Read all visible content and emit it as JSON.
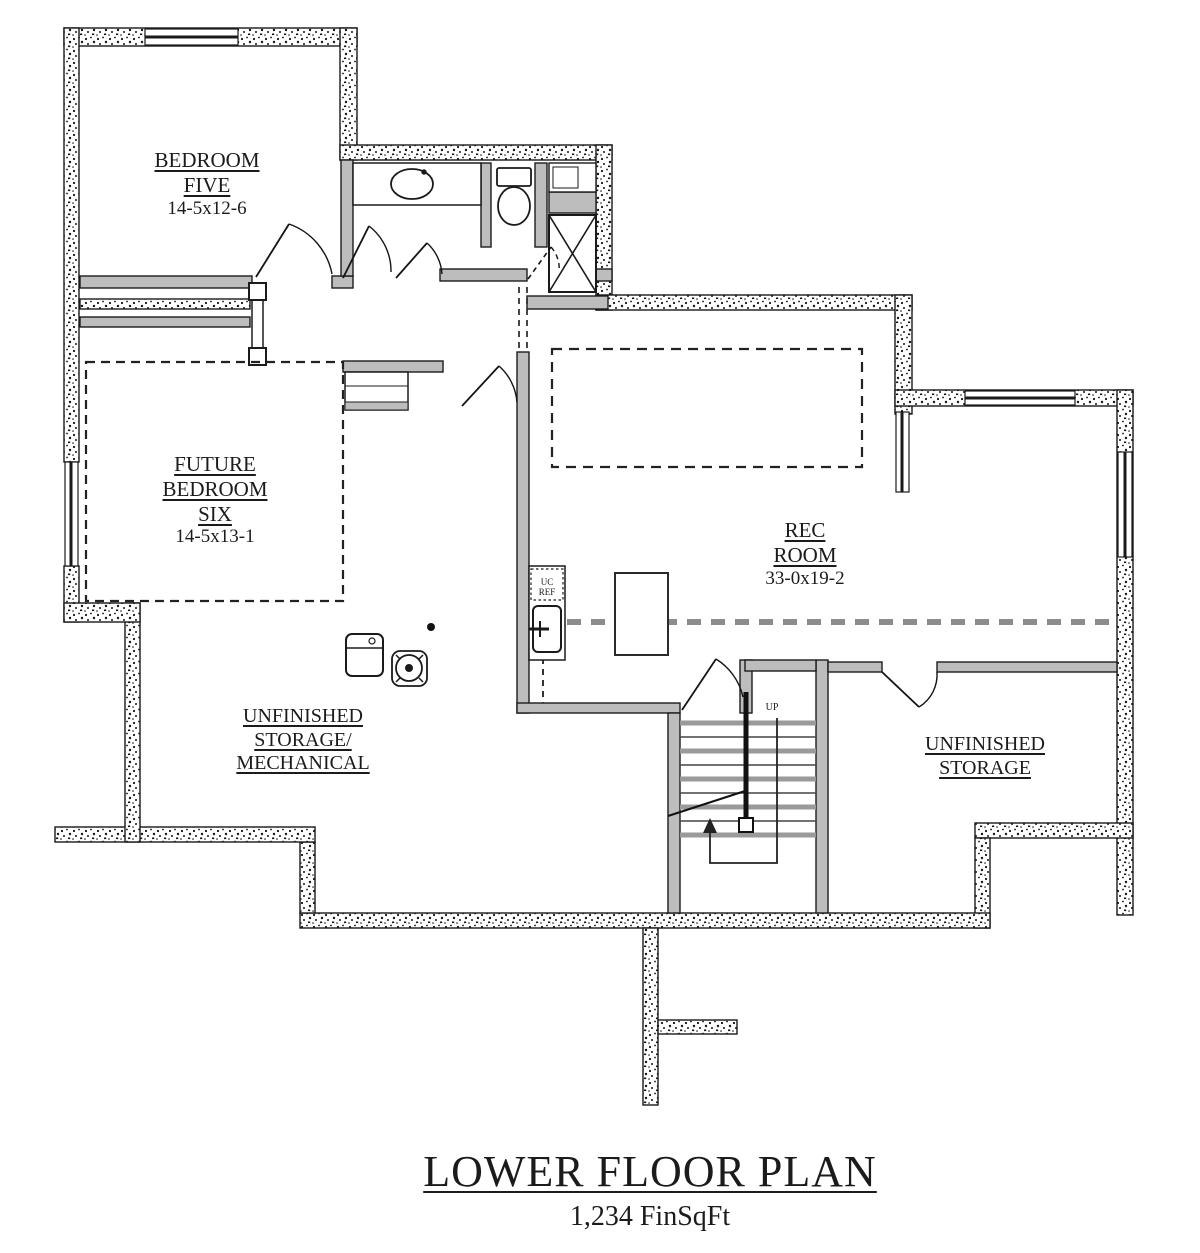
{
  "title": {
    "text": "LOWER FLOOR PLAN",
    "area": "1,234 FinSqFt"
  },
  "rooms": {
    "bedroom_five": {
      "name_lines": [
        "BEDROOM",
        "FIVE"
      ],
      "dimensions": "14-5x12-6"
    },
    "future_bedroom_six": {
      "name_lines": [
        "FUTURE",
        "BEDROOM",
        "SIX"
      ],
      "dimensions": "14-5x13-1"
    },
    "rec_room": {
      "name_lines": [
        "REC",
        "ROOM"
      ],
      "dimensions": "33-0x19-2"
    },
    "unfinished_storage_mechanical": {
      "name_lines": [
        "UNFINISHED",
        "STORAGE/",
        "MECHANICAL"
      ]
    },
    "unfinished_storage": {
      "name_lines": [
        "UNFINISHED",
        "STORAGE"
      ]
    }
  },
  "stairs": {
    "direction_label": "UP"
  },
  "fixtures": {
    "bar_fridge_lines": [
      "UC",
      "REF"
    ]
  },
  "colors": {
    "wall_line": "#1a1a1a",
    "interior_wall_fill": "#bdbdbd",
    "tread_gray": "#9a9a9a",
    "dashed_gray": "#8c8c8c",
    "background": "#ffffff"
  }
}
